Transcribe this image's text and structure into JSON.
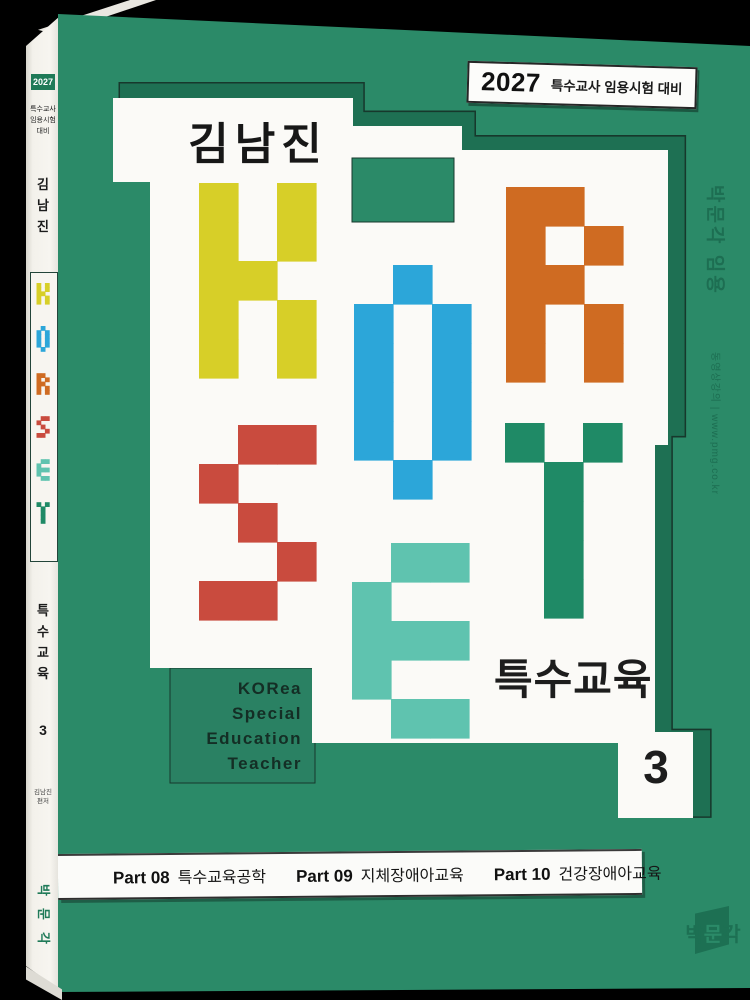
{
  "background_color": "#000000",
  "book": {
    "cover_color": "#2b8a68",
    "shadow_color": "#1e7053",
    "outline_color": "#17382c",
    "blob_color": "#fbfaf7",
    "panel_color": "#2a8163",
    "spine": {
      "year_badge": "2027",
      "exam_lines": [
        "특수교사",
        "임용시험",
        "대비"
      ],
      "author_chars": [
        "김",
        "남",
        "진"
      ],
      "subject_chars": [
        "특",
        "수",
        "교",
        "육"
      ],
      "volume": "3",
      "credit_lines": [
        "김남진",
        "편저"
      ],
      "publisher_chars": [
        "박",
        "문",
        "각"
      ]
    },
    "cover": {
      "badge": {
        "year": "2027",
        "text": "특수교사 임용시험 대비"
      },
      "author": "김남진",
      "unit": 39,
      "korset_letters": [
        {
          "char": "K",
          "color": "#d7cf28",
          "x": 199,
          "y": 183,
          "grid": [
            [
              1,
              0,
              1
            ],
            [
              1,
              0,
              1
            ],
            [
              1,
              1,
              0
            ],
            [
              1,
              0,
              1
            ],
            [
              1,
              0,
              1
            ]
          ]
        },
        {
          "char": "O",
          "color": "#2ca6d9",
          "x": 354,
          "y": 265,
          "grid": [
            [
              0,
              1,
              0
            ],
            [
              1,
              0,
              1
            ],
            [
              1,
              0,
              1
            ],
            [
              1,
              0,
              1
            ],
            [
              1,
              0,
              1
            ],
            [
              0,
              1,
              0
            ]
          ]
        },
        {
          "char": "R",
          "color": "#cf6b22",
          "x": 506,
          "y": 187,
          "grid": [
            [
              1,
              1,
              0
            ],
            [
              1,
              0,
              1
            ],
            [
              1,
              1,
              0
            ],
            [
              1,
              0,
              1
            ],
            [
              1,
              0,
              1
            ]
          ]
        },
        {
          "char": "S",
          "color": "#c94b3e",
          "x": 199,
          "y": 425,
          "grid": [
            [
              0,
              1,
              1
            ],
            [
              1,
              0,
              0
            ],
            [
              0,
              1,
              0
            ],
            [
              0,
              0,
              1
            ],
            [
              1,
              1,
              0
            ]
          ]
        },
        {
          "char": "E",
          "color": "#5fc3af",
          "x": 352,
          "y": 543,
          "grid": [
            [
              0,
              1,
              1
            ],
            [
              1,
              0,
              0
            ],
            [
              1,
              1,
              1
            ],
            [
              1,
              0,
              0
            ],
            [
              0,
              1,
              1
            ]
          ]
        },
        {
          "char": "T",
          "color": "#1f8a66",
          "x": 505,
          "y": 423,
          "grid": [
            [
              1,
              0,
              1
            ],
            [
              0,
              1,
              0
            ],
            [
              0,
              1,
              0
            ],
            [
              0,
              1,
              0
            ],
            [
              0,
              1,
              0
            ]
          ]
        }
      ],
      "subject": "특수교육",
      "volume": "3",
      "tagline_lines": [
        "KORea",
        "Special",
        "Education",
        "Teacher"
      ],
      "side_text_primary": "박문각 임용",
      "side_text_secondary": "동영상강의 | www.pmg.co.kr",
      "parts": [
        {
          "label": "Part 08",
          "title": "특수교육공학"
        },
        {
          "label": "Part 09",
          "title": "지체장애아교육"
        },
        {
          "label": "Part 10",
          "title": "건강장애아교육"
        }
      ],
      "publisher_logo_chars": [
        "박",
        "문",
        "각"
      ]
    }
  }
}
